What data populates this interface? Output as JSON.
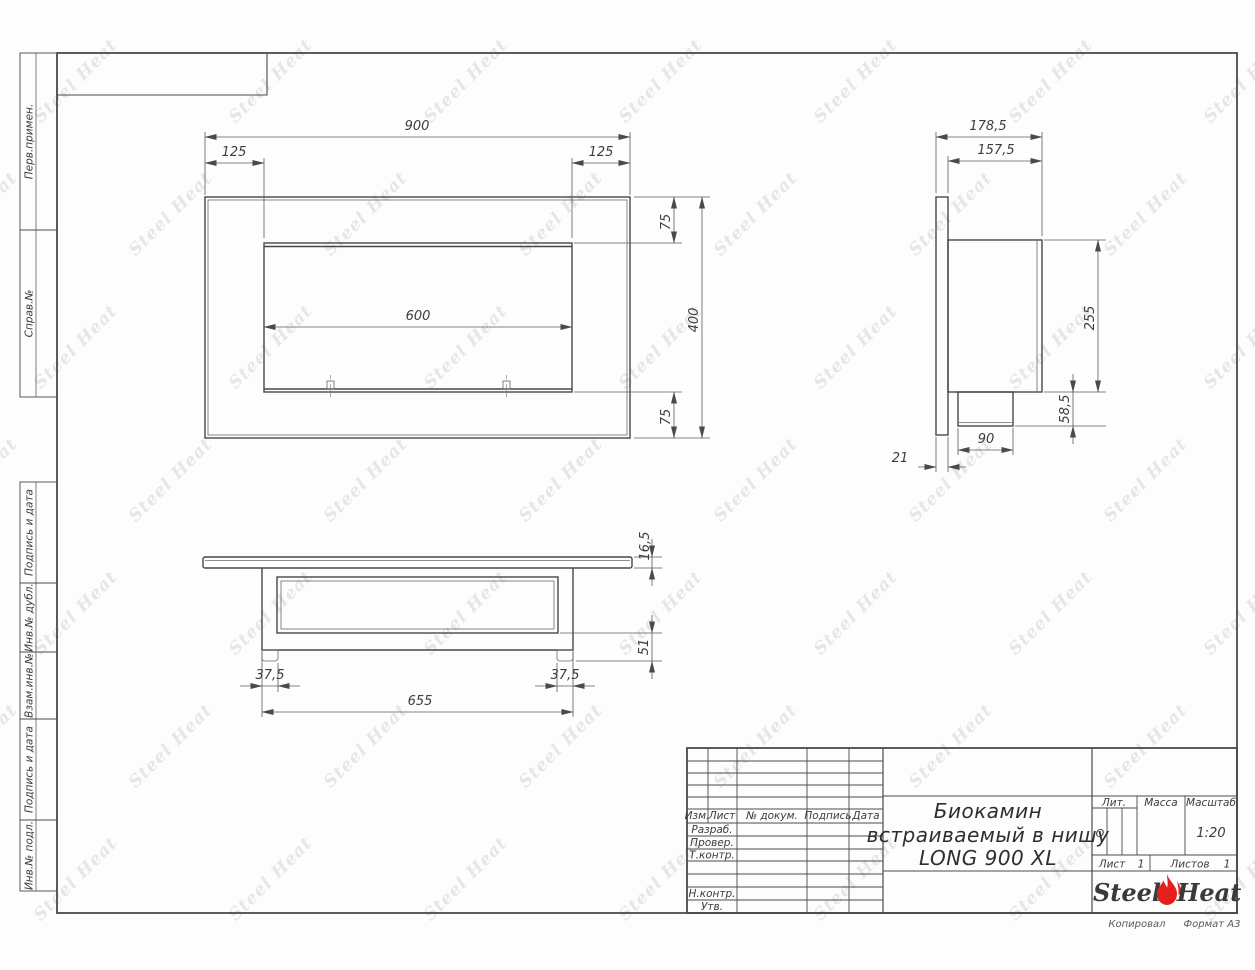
{
  "watermark": {
    "text": "Steel Heat"
  },
  "frame": {
    "left_labels": [
      "Перв.примен.",
      "Справ.№",
      "Подпись и дата",
      "Инв.№ дубл.",
      "Взам.инв.№",
      "Подпись и дата",
      "Инв.№ подл."
    ],
    "footer": {
      "copied": "Копировал",
      "format": "Формат А3"
    }
  },
  "views": {
    "front": {
      "dims": {
        "total_width": "900",
        "left_offset": "125",
        "right_offset": "125",
        "opening_width": "600",
        "top_offset": "75",
        "bottom_offset": "75",
        "total_height": "400"
      }
    },
    "side": {
      "dims": {
        "total_depth": "178,5",
        "body_depth": "157,5",
        "body_height": "255",
        "burner_height": "58,5",
        "burner_width": "90",
        "panel_thickness": "21"
      }
    },
    "bottom": {
      "dims": {
        "panel_thickness": "16,5",
        "foot_height": "51",
        "left_foot_offset": "37,5",
        "right_foot_offset": "37,5",
        "body_length": "655"
      }
    }
  },
  "title_block": {
    "change_header": {
      "izm": "Изм.",
      "list": "Лист",
      "doc": "№ докум.",
      "sign": "Подпись",
      "date": "Дата"
    },
    "staff_rows": [
      "Разраб.",
      "Провер.",
      "Т.контр.",
      "Н.контр.",
      "Утв."
    ],
    "title_lines": [
      "Биокамин",
      "встраиваемый в нишу",
      "LONG 900 XL"
    ],
    "lit": {
      "label": "Лит.",
      "value": "О"
    },
    "mass": {
      "label": "Масса",
      "value": ""
    },
    "scale": {
      "label": "Масштаб",
      "value": "1:20"
    },
    "sheet": {
      "label": "Лист",
      "value": "1"
    },
    "sheets": {
      "label": "Листов",
      "value": "1"
    },
    "logo": {
      "steel": "Steel",
      "heat": "Heat"
    }
  }
}
